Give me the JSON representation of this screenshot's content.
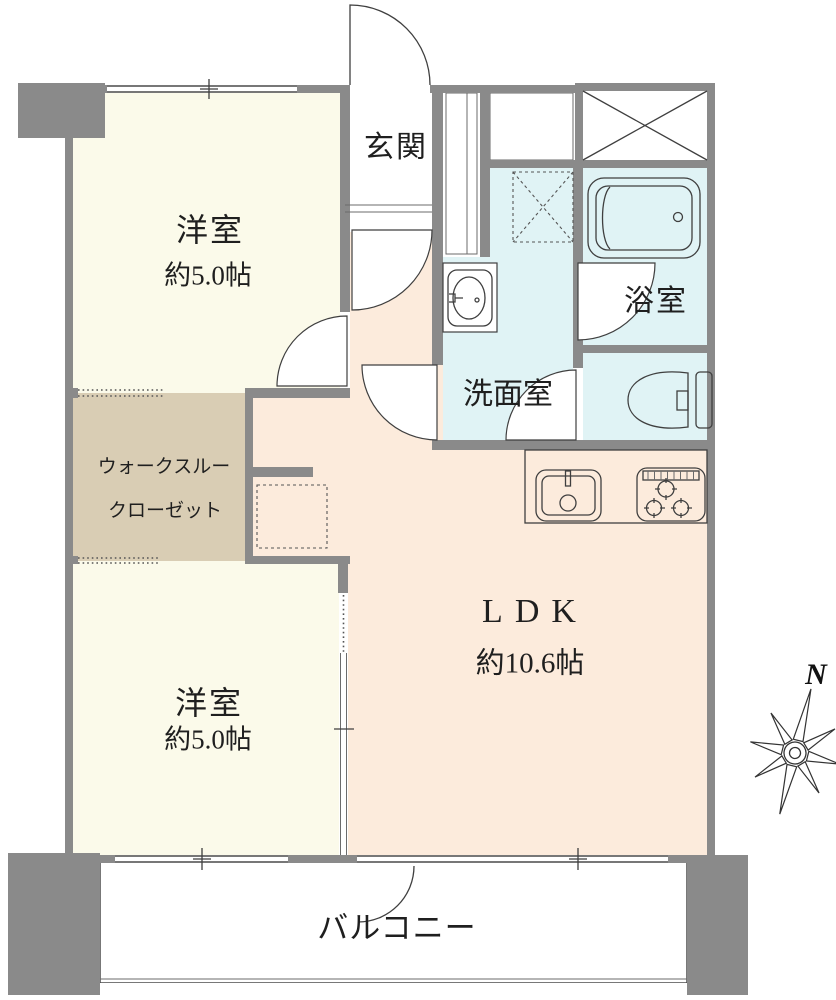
{
  "rooms": {
    "bedroom_top": {
      "label": "洋室",
      "size": "約5.0帖"
    },
    "bedroom_bottom": {
      "label": "洋室",
      "size": "約5.0帖"
    },
    "entrance": {
      "label": "玄関"
    },
    "bathroom": {
      "label": "浴室"
    },
    "washroom": {
      "label": "洗面室"
    },
    "walk_through_closet": {
      "label_line1": "ウォークスルー",
      "label_line2": "クローゼット"
    },
    "ldk": {
      "label": "LDK",
      "size": "約10.6帖"
    },
    "balcony": {
      "label": "バルコニー"
    }
  },
  "compass": {
    "north_label": "N"
  },
  "colors": {
    "wall": "#8a8a8a",
    "bedroom_floor": "#fbfaea",
    "closet_floor": "#d9cdb4",
    "ldk_floor": "#fcebdc",
    "wet_floor": "#e0f3f5",
    "balcony_floor": "#ffffff",
    "line": "#3f3f3f"
  }
}
